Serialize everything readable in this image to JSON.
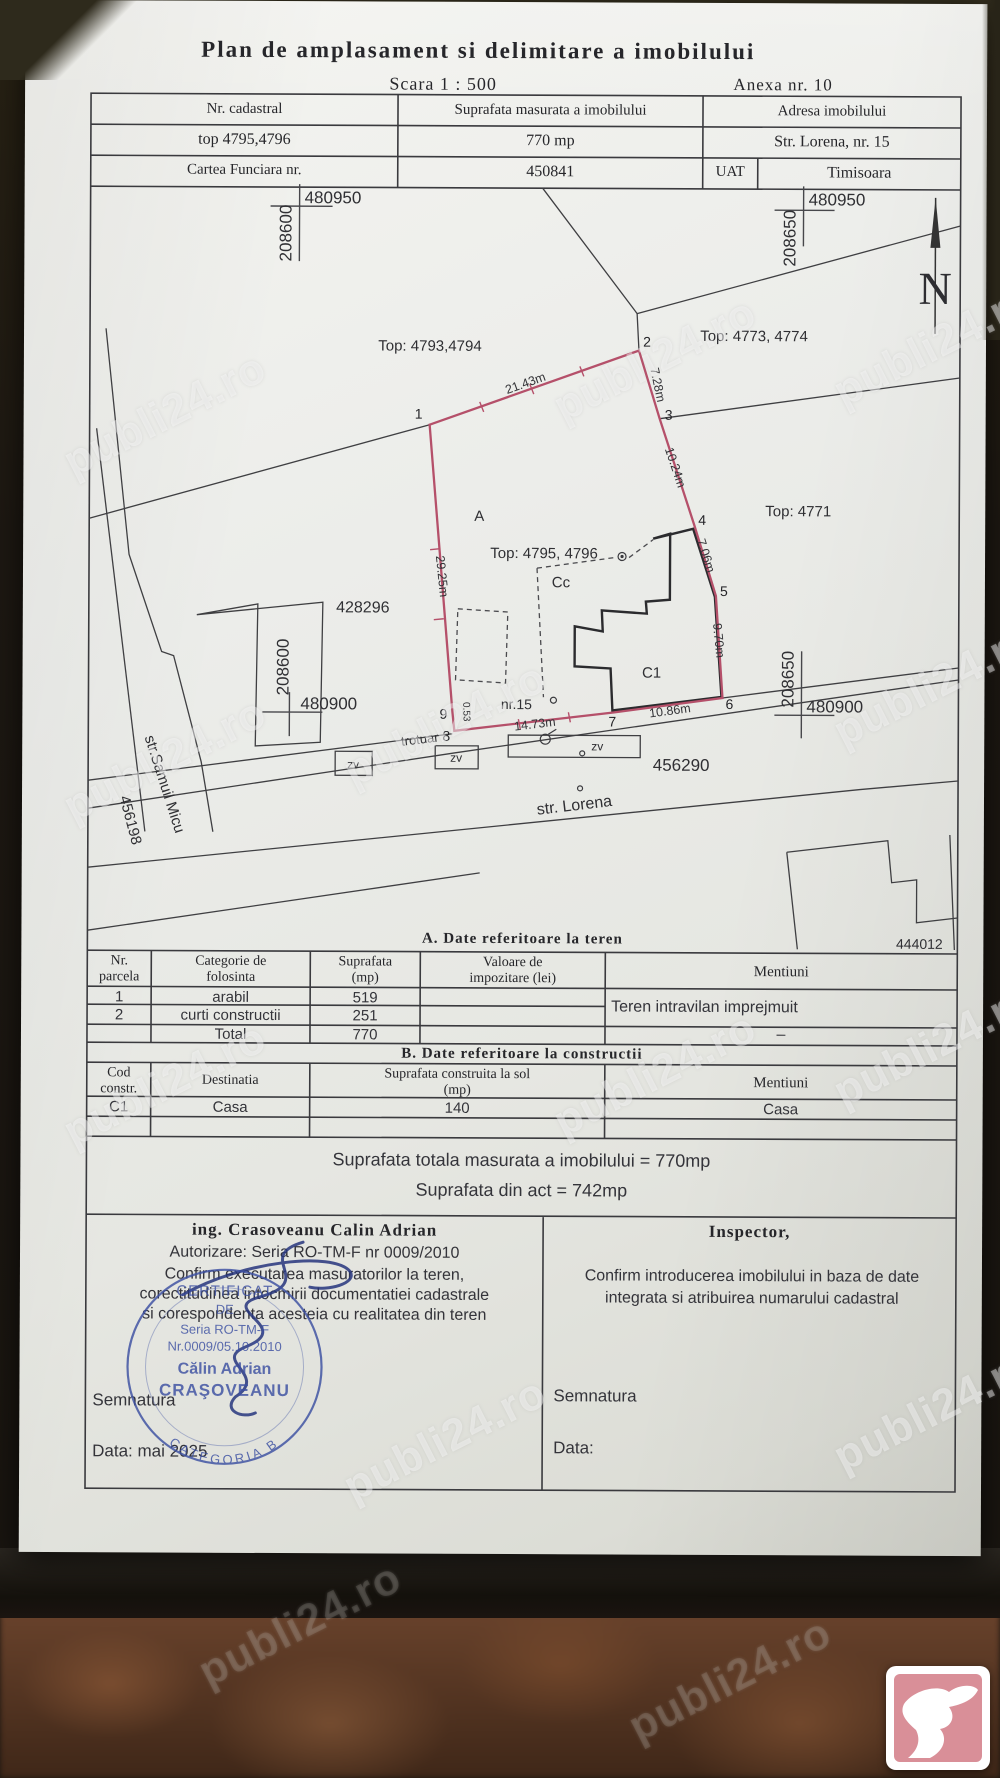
{
  "photo": {
    "watermark": "publi24.ro"
  },
  "colors": {
    "boundary_red": "#b5506a",
    "stamp_blue": "#3c50a2",
    "paper": "#ecedea"
  },
  "doc": {
    "title": "Plan de amplasament si delimitare a imobilului",
    "scale": "Scara 1 : 500",
    "annex": "Anexa nr. 10"
  },
  "header": {
    "cadastral_label": "Nr. cadastral",
    "cadastral_value": "top 4795,4796",
    "area_label": "Suprafata masurata a imobilului",
    "area_value": "770 mp",
    "address_label": "Adresa imobilului",
    "address_value": "Str. Lorena, nr. 15",
    "cf_label": "Cartea Funciara nr.",
    "cf_value": "450841",
    "uat_label": "UAT",
    "uat_value": "Timisoara"
  },
  "plan": {
    "north": "N",
    "coords": {
      "tl_e": "480950",
      "tl_n": "208600",
      "tr_e": "480950",
      "tr_n": "208650",
      "bl_e": "480900",
      "bl_n": "208600",
      "br_e": "480900",
      "br_n": "208650"
    },
    "parcels": {
      "top_left": "Top: 4793,4794",
      "top_right": "Top: 4773, 4774",
      "right": "Top: 4771",
      "subject": "Top: 4795, 4796",
      "west": "428296",
      "lorena_id": "456290",
      "samuil_id": "456198",
      "south_east": "444012"
    },
    "zones": {
      "a": "A",
      "cc": "Cc",
      "c1": "C1",
      "house_no": "nr.15",
      "sidewalk": "trotuar",
      "zv": "zv"
    },
    "streets": {
      "lorena": "str. Lorena",
      "samuil": "str.Samuil Micu"
    },
    "points": {
      "p1": "1",
      "p2": "2",
      "p3": "3",
      "p4": "4",
      "p5": "5",
      "p6": "6",
      "p7": "7",
      "p8": "8",
      "p9": "9"
    },
    "dims": {
      "d12": "21.43m",
      "d23": "7.28m",
      "d34": "10.24m",
      "d45": "7.06m",
      "d56": "9.70m",
      "d67": "10.86m",
      "d78": "14.73m",
      "d89": "0.53",
      "d91": "29.25m"
    }
  },
  "table_a": {
    "title": "A. Date referitoare la teren",
    "h_nr1": "Nr.",
    "h_nr2": "parcela",
    "h_cat1": "Categorie de",
    "h_cat2": "folosinta",
    "h_sup1": "Suprafata",
    "h_sup2": "(mp)",
    "h_val1": "Valoare de",
    "h_val2": "impozitare (lei)",
    "h_men": "Mentiuni",
    "r1_nr": "1",
    "r1_cat": "arabil",
    "r1_sup": "519",
    "r2_nr": "2",
    "r2_cat": "curti constructii",
    "r2_sup": "251",
    "total_label": "Total",
    "total_sup": "770",
    "mentiuni": "Teren intravilan imprejmuit",
    "total_men": "–"
  },
  "table_b": {
    "title": "B. Date referitoare la constructii",
    "h_cod1": "Cod",
    "h_cod2": "constr.",
    "h_dest": "Destinatia",
    "h_sup1": "Suprafata construita la sol",
    "h_sup2": "(mp)",
    "h_men": "Mentiuni",
    "r_cod": "C1",
    "r_dest": "Casa",
    "r_sup": "140",
    "r_men": "Casa"
  },
  "totals": {
    "measured": "Suprafata totala masurata a imobilului = 770mp",
    "act": "Suprafata din act = 742mp"
  },
  "executant": {
    "name": "ing. Crasoveanu Calin Adrian",
    "auth": "Autorizare: Seria RO-TM-F nr 0009/2010",
    "line1": "Confirm executarea masuratorilor la teren,",
    "line2": "corectitudinea intocmirii documentatiei cadastrale",
    "line3": "si corespondenta acesteia cu realitatea din teren",
    "signature_label": "Semnatura",
    "date": "Data: mai 2025"
  },
  "inspector": {
    "title": "Inspector,",
    "line1": "Confirm introducerea imobilului in baza de date",
    "line2": "integrata si atribuirea numarului cadastral",
    "signature_label": "Semnatura",
    "date": "Data:"
  },
  "stamp": {
    "cert1": "CERTIFICAT",
    "cert2": "DE",
    "seria": "Seria RO-TM-F",
    "nr": "Nr.0009/05.10.2010",
    "name1": "Călin Adrian",
    "name2": "CRAŞOVEANU",
    "category": "CATEGORIA B"
  }
}
